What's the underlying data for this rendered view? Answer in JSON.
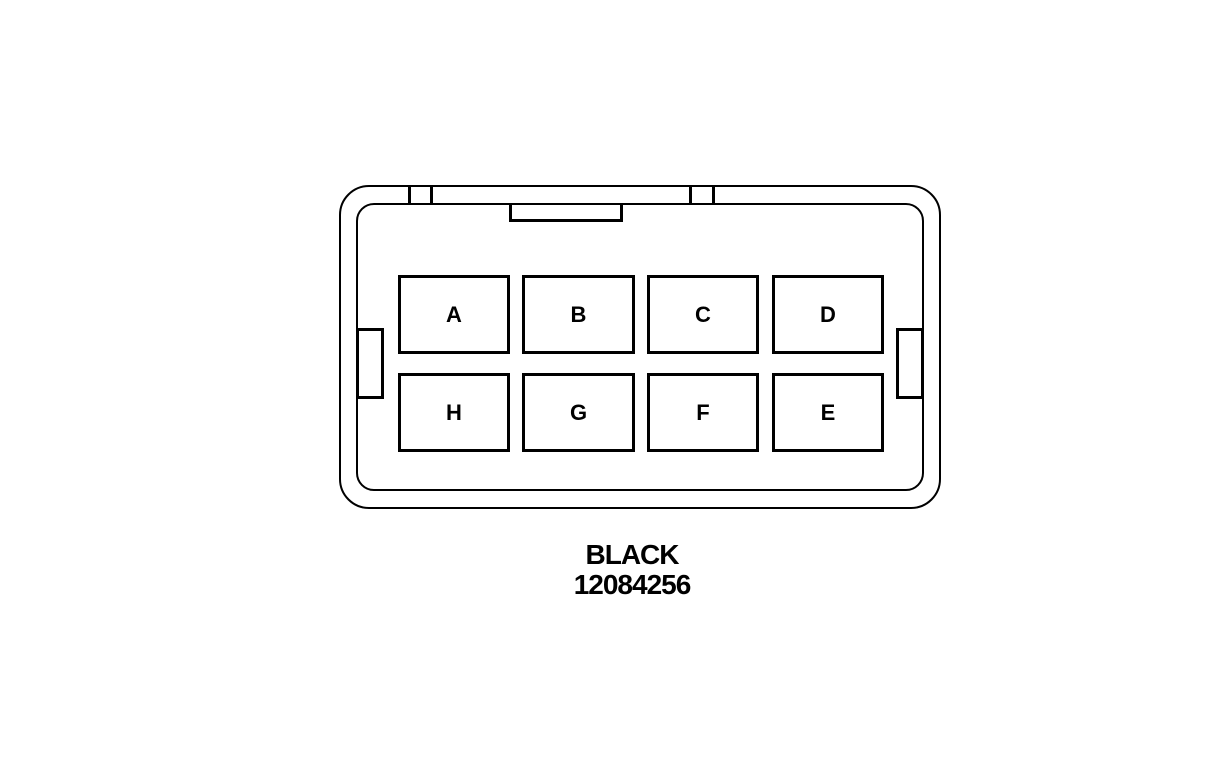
{
  "connector": {
    "color_label": "BLACK",
    "part_number": "12084256",
    "pins": {
      "row1": [
        "A",
        "B",
        "C",
        "D"
      ],
      "row2": [
        "H",
        "G",
        "F",
        "E"
      ]
    }
  },
  "colors": {
    "line": "#000000",
    "background": "#ffffff"
  }
}
